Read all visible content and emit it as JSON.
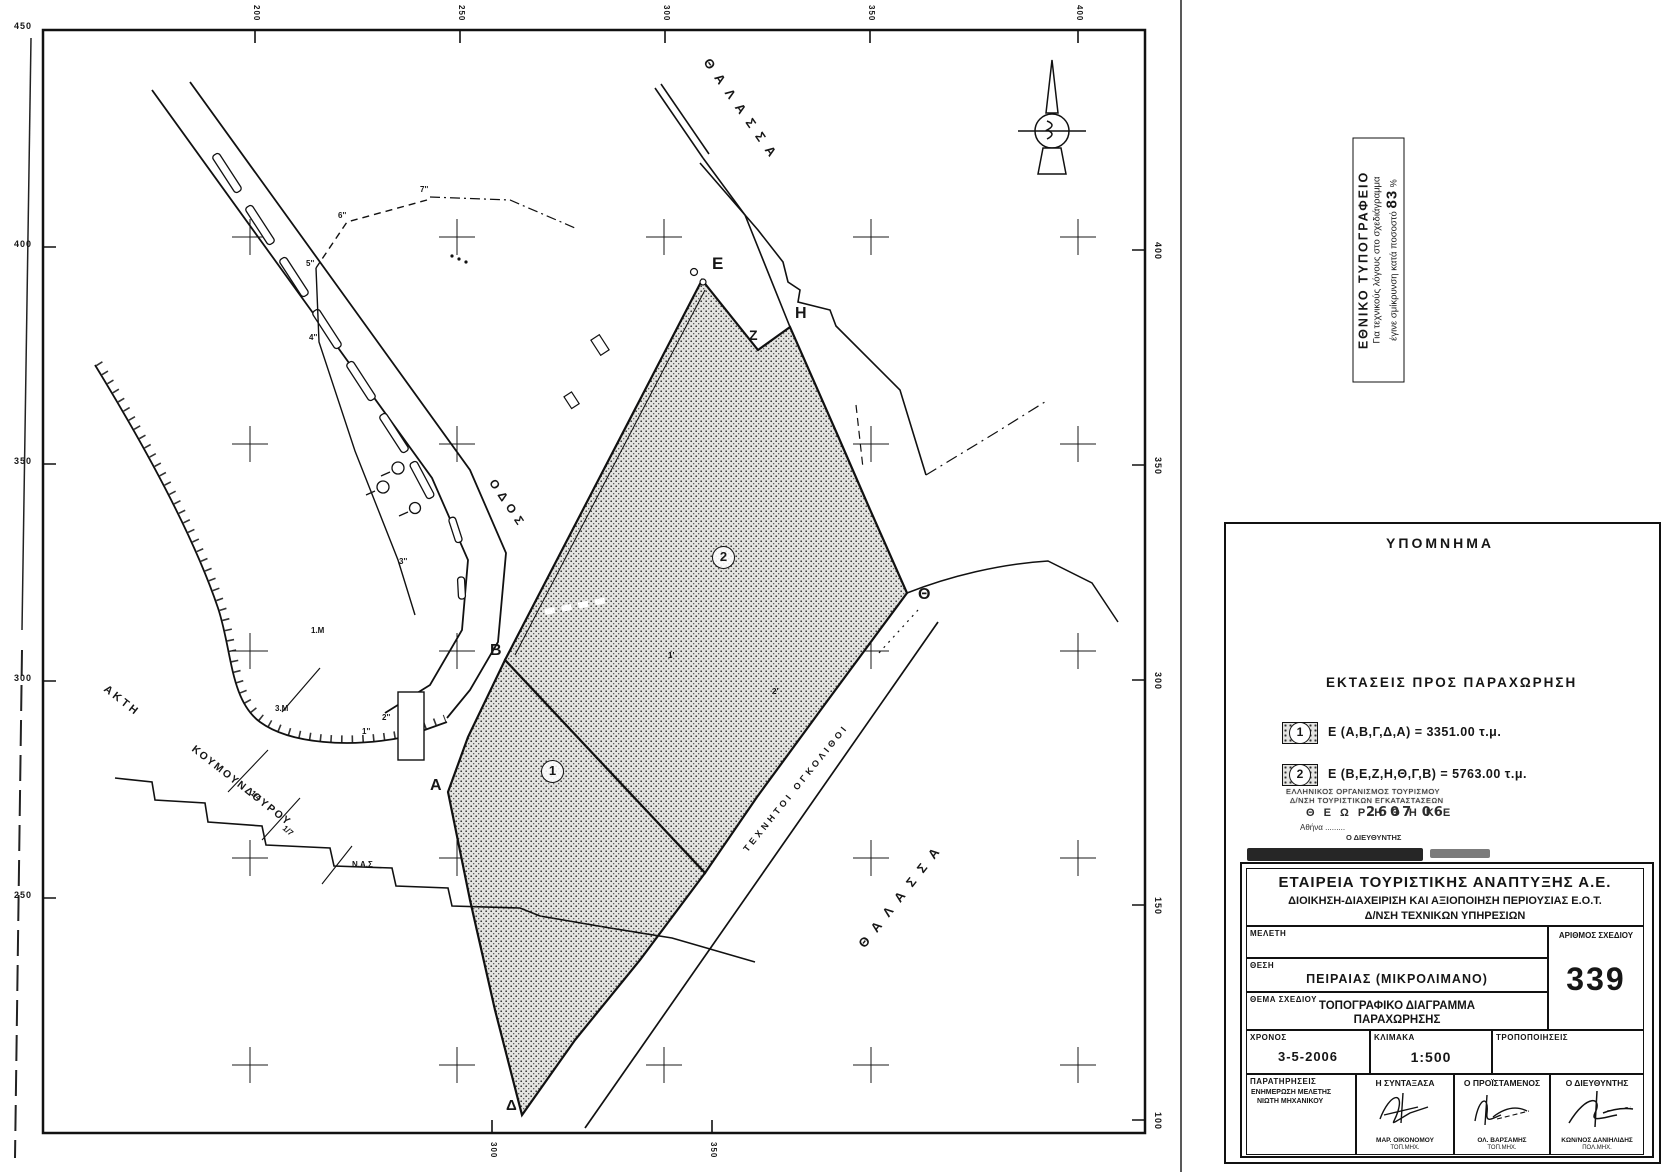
{
  "map": {
    "grid": {
      "left": [
        "450",
        "400",
        "350",
        "300",
        "250"
      ],
      "right": [
        "400",
        "350",
        "300",
        "150",
        "100"
      ],
      "top": [
        "200",
        "250",
        "300",
        "350",
        "400"
      ],
      "bottom": [
        "300",
        "350"
      ]
    },
    "labels": {
      "sea_top": "ΘΑΛΑΣΣΑ",
      "sea_bottom": "ΘΑΛΑΣΣΑ",
      "road": "ΟΔΟΣ",
      "quay_1": "ΑΚΤΗ",
      "quay_2": "ΚΟΥΜΟΥΝΔΟΥΡΟΥ",
      "blocks": "ΤΕΧΝΗΤΟΙ ΟΓΚΟΛΙΘΟΙ"
    },
    "vertices": {
      "a": "Α",
      "b": "Β",
      "d": "Δ",
      "e": "Ε",
      "z": "Ζ",
      "h": "Η",
      "th": "Θ"
    },
    "area_1": "1",
    "area_2": "2",
    "points": [
      "7''",
      "6''",
      "5''",
      "4''",
      "3''",
      "2''",
      "1''",
      "1'",
      "2'",
      "1/4",
      "1/7",
      "Ν.Α.Σ",
      "1.Μ",
      "3.Μ"
    ]
  },
  "print_note": {
    "title": "ΕΘΝΙΚΟ ΤΥΠΟΓΡΑΦΕΙΟ",
    "line1": "Για τεχνικούς λόγους στο σχεδιάγραμμα",
    "line2": "έγινε σμίκρυνση κατά ποσοστό",
    "value": "83",
    "unit": "%"
  },
  "legend": {
    "title": "ΥΠΟΜΝΗΜΑ",
    "section": "ΕΚΤΑΣΕΙΣ ΠΡΟΣ ΠΑΡΑΧΩΡΗΣΗ",
    "items": [
      {
        "num": "1",
        "text": "Ε (Α,Β,Γ,Δ,Α) = 3351.00 τ.μ."
      },
      {
        "num": "2",
        "text": "Ε (Β,Ε,Ζ,Η,Θ,Γ,Β) = 5763.00 τ.μ."
      }
    ]
  },
  "approval": {
    "org_line1": "ΕΛΛΗΝΙΚΟΣ ΟΡΓΑΝΙΣΜΟΣ ΤΟΥΡΙΣΜΟΥ",
    "org_line2": "Δ/ΝΣΗ ΤΟΥΡΙΣΤΙΚΩΝ ΕΓΚΑΤΑΣΤΑΣΕΩΝ",
    "approved": "Θ Ε Ω Ρ Η Θ Η Κ Ε",
    "date": "2607 06",
    "place": "Αθήνα .........",
    "signer": "Ο ΔΙΕΥΘΥΝΤΗΣ"
  },
  "titleblock": {
    "org1": "ΕΤΑΙΡΕΙΑ ΤΟΥΡΙΣΤΙΚΗΣ ΑΝΑΠΤΥΞΗΣ Α.Ε.",
    "org2": "ΔΙΟΙΚΗΣΗ-ΔΙΑΧΕΙΡΙΣΗ ΚΑΙ ΑΞΙΟΠΟΙΗΣΗ ΠΕΡΙΟΥΣΙΑΣ Ε.Ο.Τ.",
    "org3": "Δ/ΝΣΗ ΤΕΧΝΙΚΩΝ ΥΠΗΡΕΣΙΩΝ",
    "meleti_label": "ΜΕΛΕΤΗ",
    "meleti": "",
    "thesi_label": "ΘΕΣΗ",
    "thesi": "ΠΕΙΡΑΙΑΣ (ΜΙΚΡΟΛΙΜΑΝΟ)",
    "thema_label": "ΘΕΜΑ ΣΧΕΔΙΟΥ",
    "thema1": "ΤΟΠΟΓΡΑΦΙΚΟ ΔΙΑΓΡΑΜΜΑ",
    "thema2": "ΠΑΡΑΧΩΡΗΣΗΣ",
    "arithmos_label": "ΑΡΙΘΜΟΣ ΣΧΕΔΙΟΥ",
    "arithmos": "339",
    "xronos_label": "ΧΡΟΝΟΣ",
    "xronos": "3-5-2006",
    "klimaka_label": "ΚΛΙΜΑΚΑ",
    "klimaka": "1:500",
    "tropop_label": "ΤΡΟΠΟΠΟΙΗΣΕΙΣ",
    "tropop": "",
    "parat_label": "ΠΑΡΑΤΗΡΗΣΕΙΣ",
    "parat1": "ΕΝΗΜΕΡΩΣΗ ΜΕΛΕΤΗΣ",
    "parat2": "ΝΙΩΤΗ ΜΗΧΑΝΙΚΟΥ",
    "syntaxasa_label": "Η ΣΥΝΤΑΞΑΣΑ",
    "syntaxasa_name": "ΜΑΡ. ΟΙΚΟΝΟΜΟΥ",
    "syntaxasa_title": "ΤΟΠ.ΜΗΧ.",
    "proistamenos_label": "Ο ΠΡΟΪΣΤΑΜΕΝΟΣ",
    "proistamenos_name": "ΟΛ. ΒΑΡΣΑΜΗΣ",
    "proistamenos_title": "ΤΟΠ.ΜΗΧ.",
    "dieythintis_label": "Ο ΔΙΕΥΘΥΝΤΗΣ",
    "dieythintis_name": "ΚΩΝ/ΝΟΣ ΔΑΝΙΗΛΙΔΗΣ",
    "dieythintis_title": "ΠΟΛ.ΜΗΧ."
  }
}
